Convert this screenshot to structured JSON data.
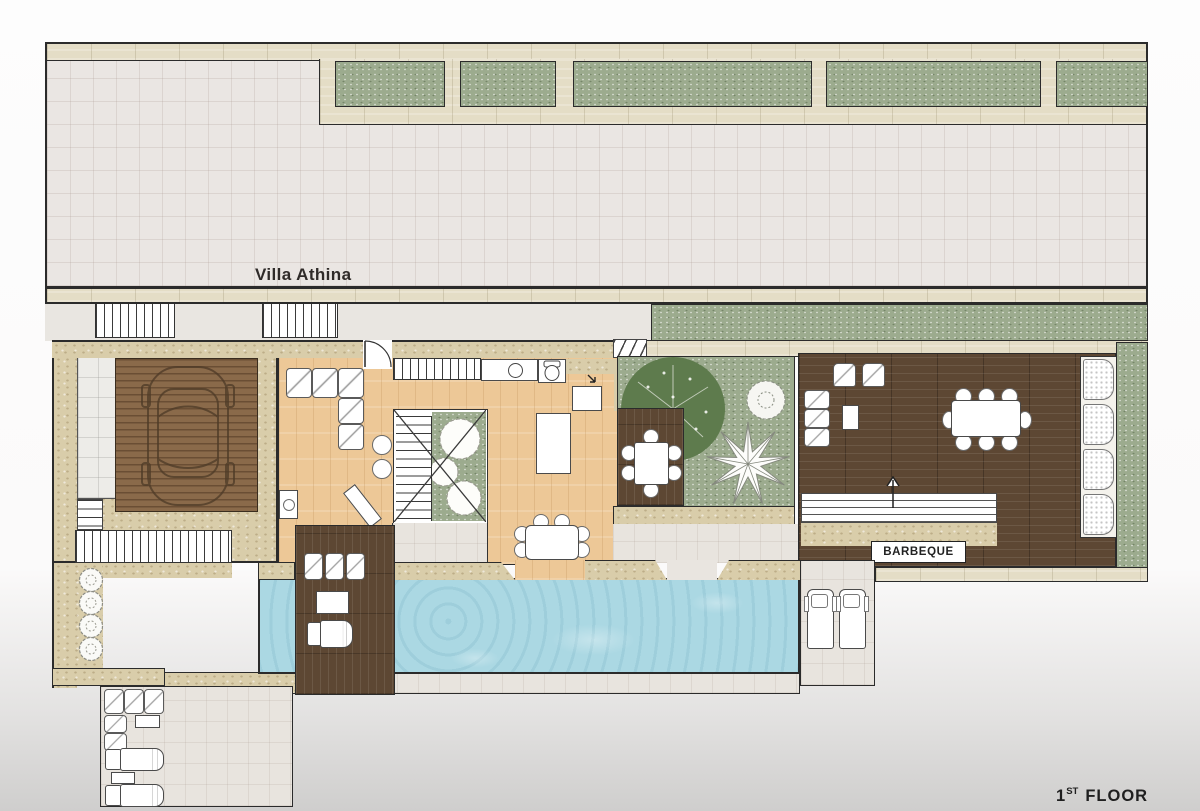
{
  "title": "Villa Athina",
  "floor_label": {
    "number": "1",
    "ordinal": "ST",
    "word": "FLOOR"
  },
  "labels": {
    "barbeque": "BARBEQUE"
  },
  "colors": {
    "background_top": "#fdfdfd",
    "background_bottom": "#cfcecd",
    "wall_band": "#e4ddc6",
    "stone_wall": "#d9cdaa",
    "terrace": "#eae6e3",
    "terrace_warm": "#e8e4de",
    "grass": "#9cab8e",
    "tree_dark": "#5e7b4d",
    "garage_deck": "#8a6a4a",
    "dark_wood": "#5d4733",
    "indoor_wood": "#edc897",
    "pool_water": "#abd8e3",
    "line": "#2b2b2b"
  }
}
